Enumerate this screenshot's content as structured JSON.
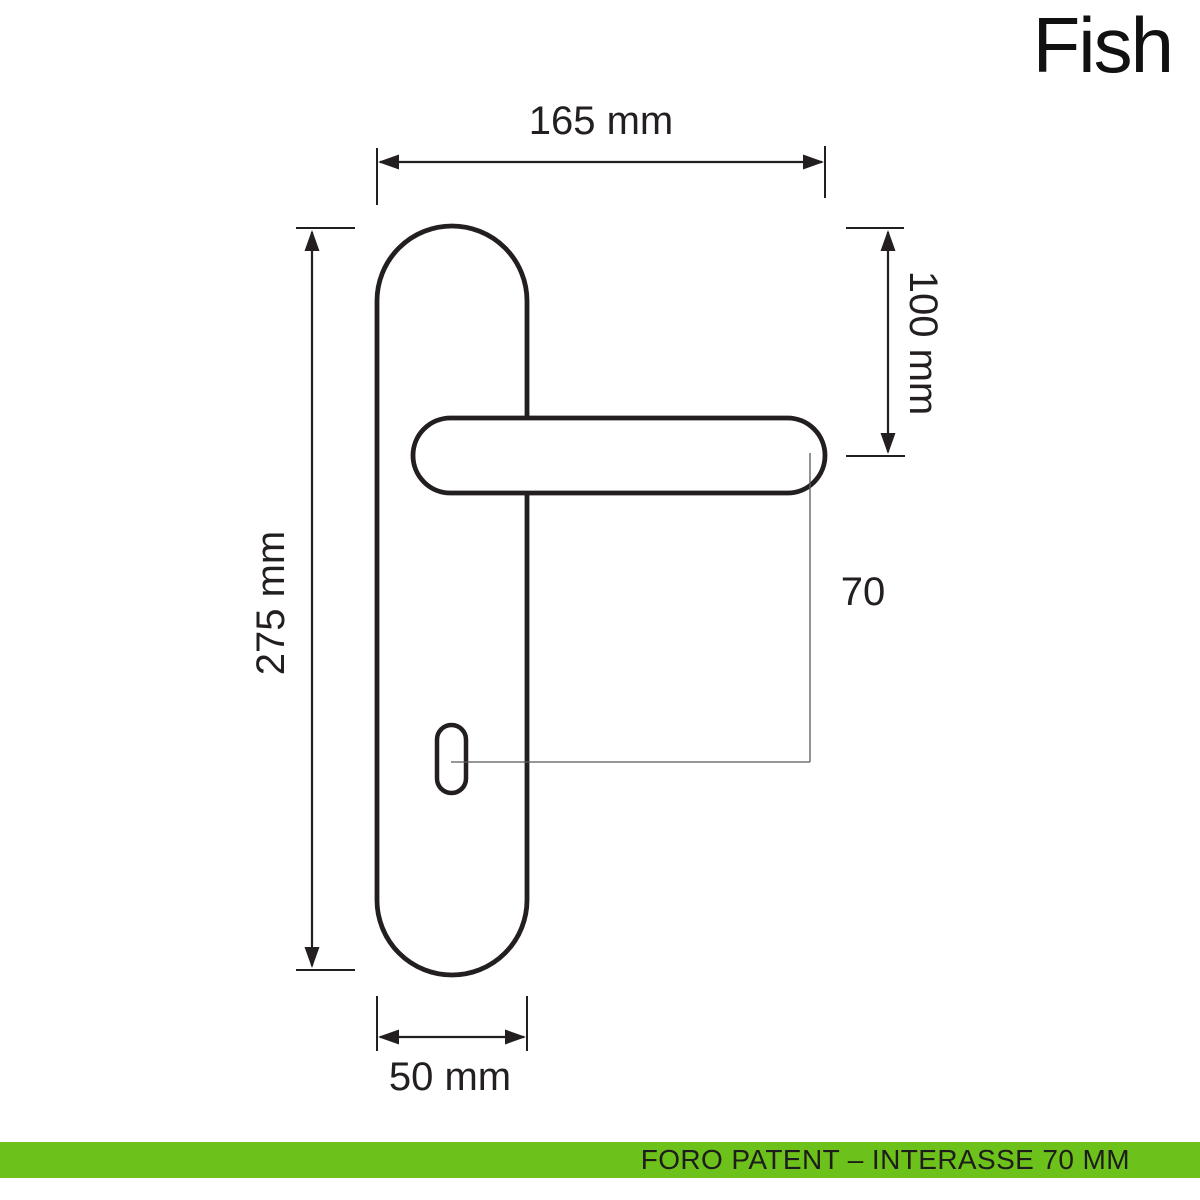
{
  "title": "Fish",
  "drawing": {
    "subject": "door-handle-with-backplate-technical-drawing",
    "stroke_color": "#231f20",
    "labels": {
      "total_width": "165 mm",
      "plate_top_to_handle_axis": "100 mm",
      "plate_height": "275 mm",
      "handle_axis_to_keyhole": "70",
      "plate_width": "50 mm"
    }
  },
  "footer": {
    "text": "FORO PATENT – INTERASSE 70 MM",
    "background_color": "#6cc11b",
    "text_color": "#1d1d1b"
  }
}
